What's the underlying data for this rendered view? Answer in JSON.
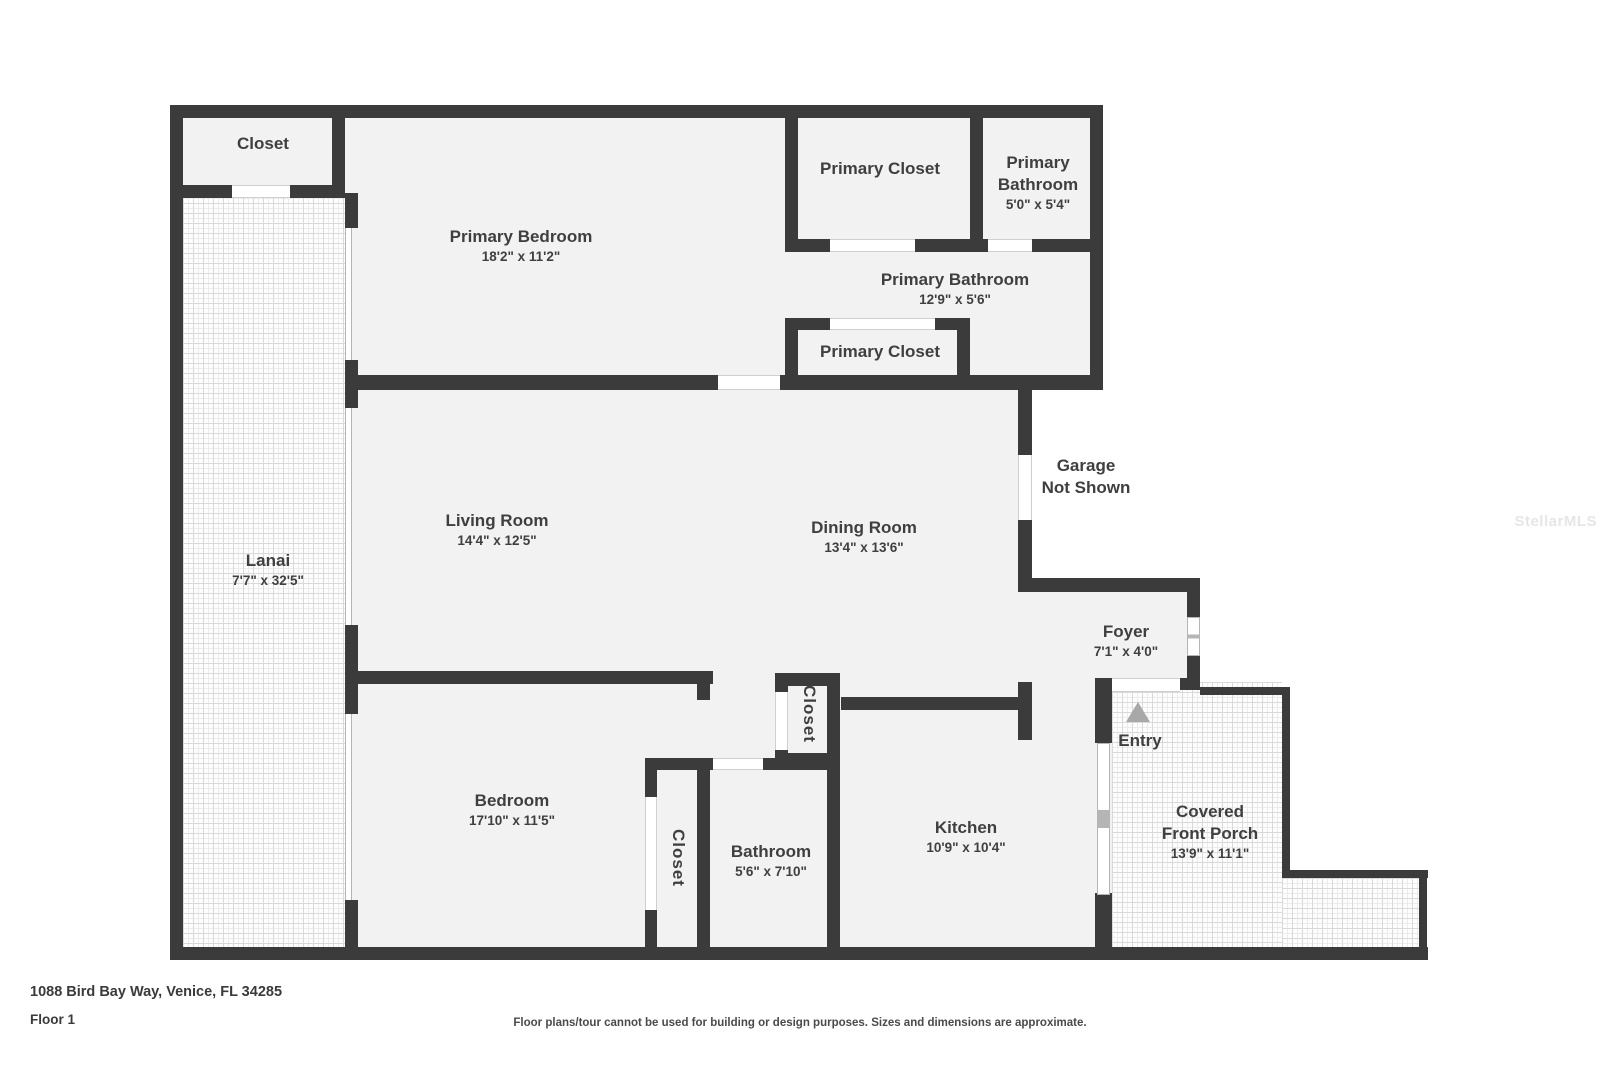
{
  "page": {
    "address": "1088 Bird Bay Way, Venice, FL 34285",
    "floor_label": "Floor 1",
    "disclaimer": "Floor plans/tour cannot be used for building or design purposes. Sizes and dimensions are approximate.",
    "watermark": "StellarMLS"
  },
  "colors": {
    "wall": "#3b3b3b",
    "floor": "#f2f2f2",
    "text": "#3f3f3f",
    "arrow": "#a8a8a8",
    "watermark": "#e6e6e6"
  },
  "rooms": {
    "closet_top_left": {
      "name": "Closet"
    },
    "primary_bedroom": {
      "name": "Primary Bedroom",
      "dims": "18'2\" x 11'2\""
    },
    "primary_closet_top": {
      "name": "Primary Closet"
    },
    "primary_bathroom_small": {
      "name_line1": "Primary",
      "name_line2": "Bathroom",
      "dims": "5'0\" x 5'4\""
    },
    "primary_bathroom": {
      "name": "Primary Bathroom",
      "dims": "12'9\" x 5'6\""
    },
    "primary_closet_2": {
      "name": "Primary Closet"
    },
    "living_room": {
      "name": "Living Room",
      "dims": "14'4\" x 12'5\""
    },
    "dining_room": {
      "name": "Dining Room",
      "dims": "13'4\" x 13'6\""
    },
    "garage": {
      "name_line1": "Garage",
      "name_line2": "Not Shown"
    },
    "lanai": {
      "name": "Lanai",
      "dims": "7'7\" x 32'5\""
    },
    "foyer": {
      "name": "Foyer",
      "dims": "7'1\" x 4'0\""
    },
    "entry": {
      "name": "Entry"
    },
    "covered_front_porch": {
      "name_line1": "Covered",
      "name_line2": "Front Porch",
      "dims": "13'9\" x 11'1\""
    },
    "kitchen": {
      "name": "Kitchen",
      "dims": "10'9\" x 10'4\""
    },
    "bedroom": {
      "name": "Bedroom",
      "dims": "17'10\" x 11'5\""
    },
    "bathroom": {
      "name": "Bathroom",
      "dims": "5'6\" x 7'10\""
    },
    "closet_hall": {
      "name": "Closet"
    },
    "closet_bedroom": {
      "name": "Closet"
    }
  }
}
